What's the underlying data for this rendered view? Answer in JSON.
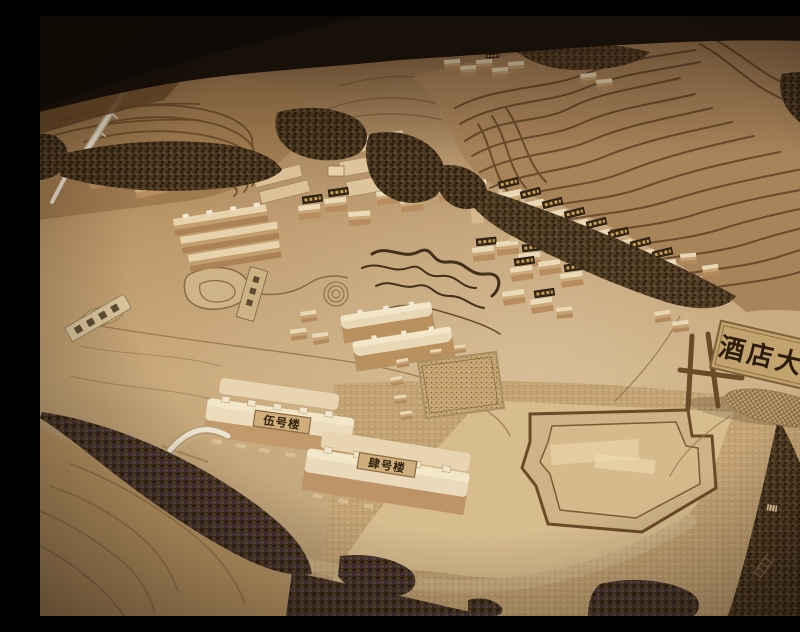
{
  "scene": {
    "alt": "Photograph of a wooden architectural scale model of a hillside resort: laser-cut contour terraces, sponge trees, small wooden buildings, engraved roads, and labelled sign plaques.",
    "illegible_small_plaques": true
  },
  "signs": {
    "hotel_lobby_gate": {
      "label": "酒店大堂"
    },
    "building_no5": {
      "label": "伍号楼"
    },
    "building_no4": {
      "label": "肆号楼"
    }
  },
  "colors": {
    "room_dark": "#171008",
    "table_wood": "#5d3f22",
    "model_tan": "#c6a171",
    "terrace_groove": "#5f4325",
    "tree_dark": "#352817",
    "plaque_light": "#cfae7b",
    "plaque_dark": "#342718",
    "sign_board": "#c2a26d",
    "sign_text": "#2b1c0e",
    "plywood_light": "#d7bc8e"
  }
}
